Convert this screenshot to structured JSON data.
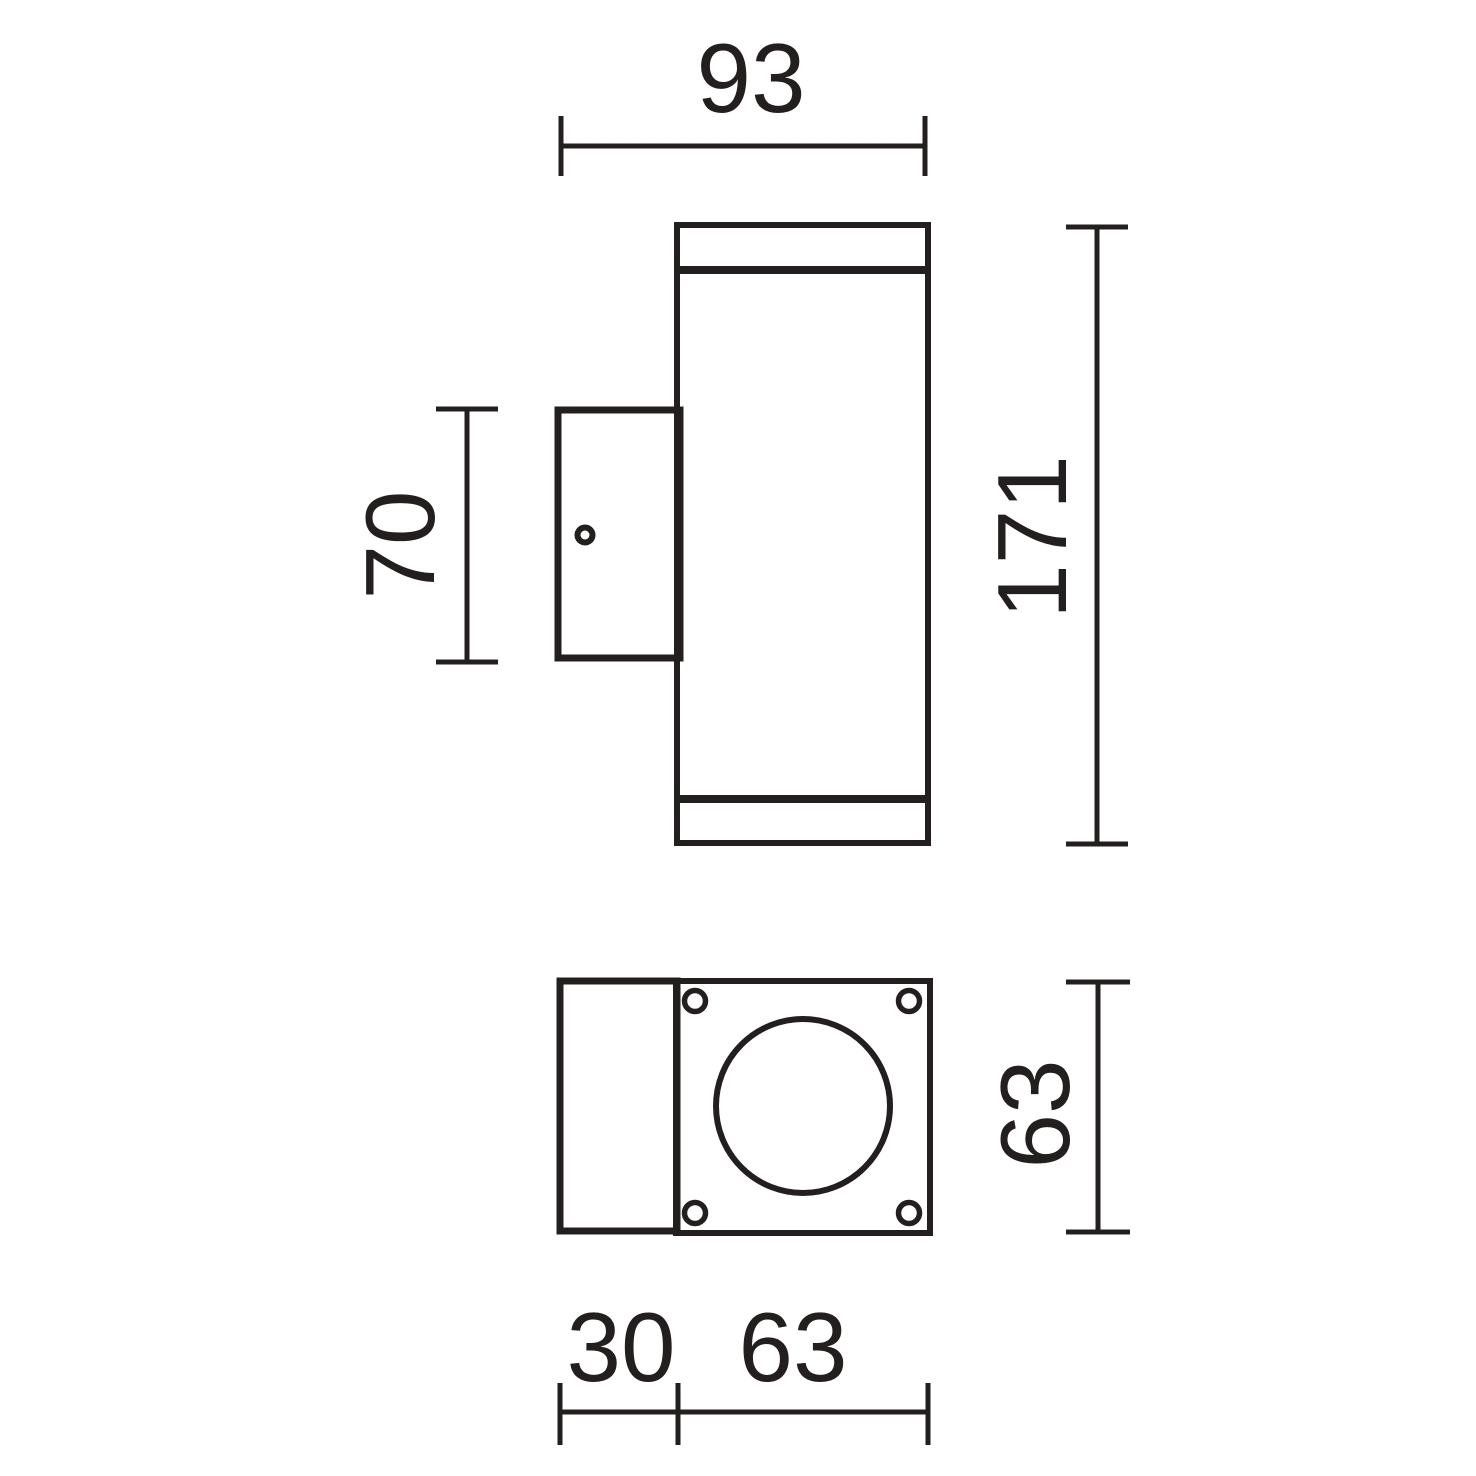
{
  "drawing": {
    "stroke_color": "#241f1f",
    "background_color": "#ffffff",
    "side_view": {
      "width_label": "93",
      "height_label": "171",
      "bracket_height_label": "70"
    },
    "bottom_view": {
      "height_label": "63",
      "bracket_depth_label": "30",
      "width_label": "63"
    }
  }
}
